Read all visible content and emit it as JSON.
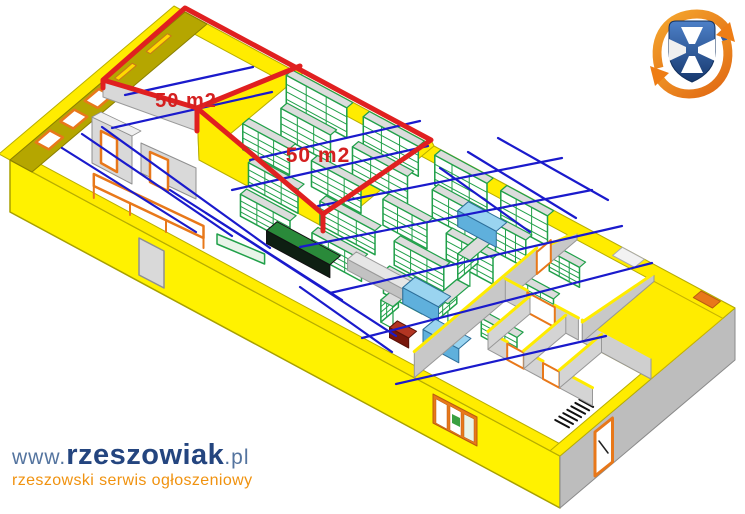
{
  "scene": {
    "type": "3d-floor-plan",
    "rooms": [
      {
        "id": "room-1",
        "label": "50 m2"
      },
      {
        "id": "room-2",
        "label": "50 m2"
      }
    ],
    "colors": {
      "background": "#ffffff",
      "wall_yellow": "#ffec00",
      "wall_yellow_face": "#fff200",
      "wall_olive": "#b5a600",
      "wall_gray": "#c8c8c8",
      "wall_gray_light": "#d9d9d9",
      "floor_white": "#ffffff",
      "outline_olive": "#a8a000",
      "highlight_red": "#e02020",
      "label_red": "#d42020",
      "wiring_blue": "#1a1acc",
      "shelf_green": "#21a04a",
      "shelf_top_gray": "#dcdcdc",
      "counter_dark_green": "#2a8a3a",
      "counter_front_dark": "#0e1f12",
      "table_cyan": "#9ad4f0",
      "table_cyan_front": "#5fb0dc",
      "box_red": "#b23522",
      "frame_orange": "#e8781a",
      "exterior_gray": "#bdbdbd"
    }
  },
  "branding": {
    "logo": {
      "icon": "rzeszowiak-shield-logo",
      "shield_blue": "#2d5da8",
      "shield_blue_dark": "#16386e",
      "arrow_orange": "#f08a1d",
      "arrow_orange_dark": "#e06612",
      "cross_white": "#ffffff"
    },
    "website_prefix": "www.",
    "website_name": "rzeszowiak",
    "website_tld": ".pl",
    "tagline": "rzeszowski serwis ogłoszeniowy",
    "prefix_color": "#54749f",
    "name_color": "#24457f",
    "tagline_color": "#f0920f"
  }
}
